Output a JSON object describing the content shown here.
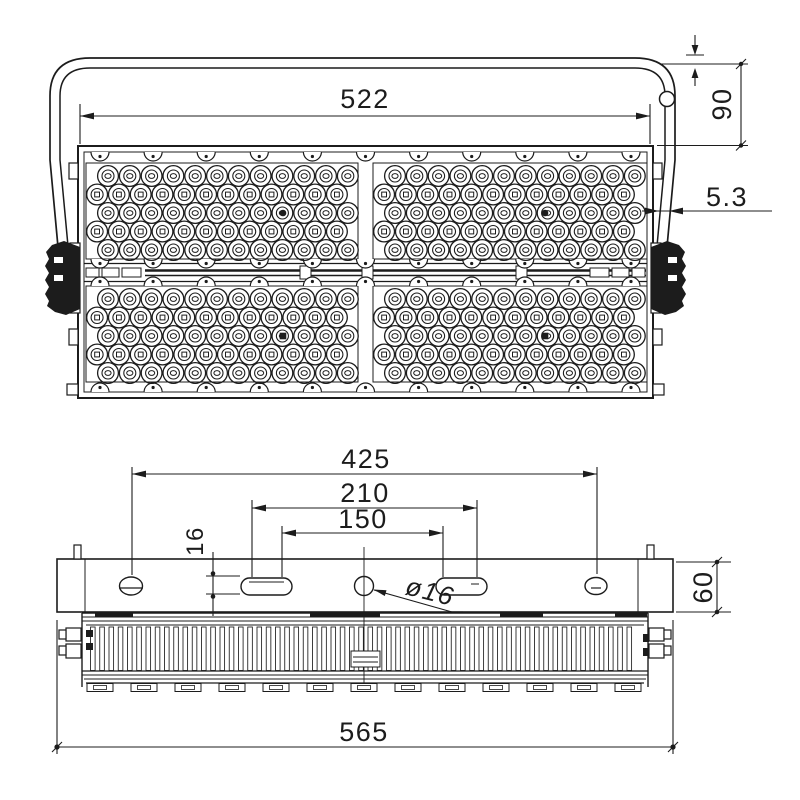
{
  "page": {
    "title": "LED flood light dimensional drawing",
    "background": "#ffffff",
    "line_color": "#1c1c1c"
  },
  "front_view": {
    "name": "Front view with mounting bracket",
    "dimensions": {
      "body_width": "522",
      "bracket_height": "90",
      "bracket_strap": "5.3"
    },
    "led_array": {
      "modules": 4,
      "rows_per_module": 5,
      "cells_per_row": 12
    }
  },
  "top_view": {
    "name": "Top view of mounting plate and heat sink",
    "dimensions": {
      "outer_hole_spacing": "425",
      "slot_spacing_outer": "210",
      "slot_spacing_inner": "150",
      "slot_width": "16",
      "center_hole": "ø16",
      "plate_depth": "60",
      "overall_width": "565"
    },
    "heatsink": {
      "fin_count": 59,
      "foot_count": 13
    }
  }
}
